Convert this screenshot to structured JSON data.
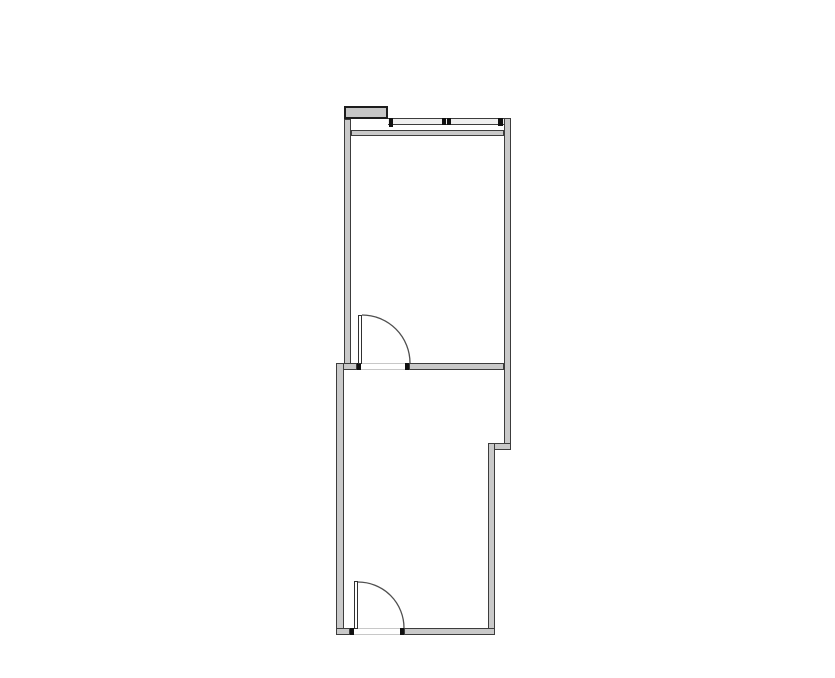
{
  "document": {
    "kind": "architectural-floor-plan",
    "visible_text": []
  },
  "canvas": {
    "width": 835,
    "height": 678,
    "background": "#ffffff"
  },
  "palette": {
    "wall_fill": "#c9c9c9",
    "wall_edge": "#3c3c3c",
    "tab_fill": "#c6c6c6",
    "tab_edge": "#1c1c1c",
    "glass_fill": "#efefef",
    "mullion_mark": "#101010",
    "threshold_edge": "#c8c8c8",
    "door_arc_stroke": "#4f4f4f",
    "door_leaf_fill": "#ffffff"
  },
  "floorplan": {
    "rooms": [
      {
        "name": "upper-room",
        "bounds": {
          "x": 344,
          "y": 106,
          "w": 167,
          "h": 264
        }
      },
      {
        "name": "lower-room",
        "bounds": {
          "x": 336,
          "y": 363,
          "w": 175,
          "h": 272
        }
      }
    ],
    "layers": {
      "walls": [
        {
          "name": "wall-left-upper",
          "x": 344,
          "y": 119,
          "w": 7,
          "h": 251
        },
        {
          "name": "wall-right-upper",
          "x": 504,
          "y": 118,
          "w": 7,
          "h": 332
        },
        {
          "name": "wall-top-inner-band",
          "x": 351,
          "y": 130,
          "w": 153,
          "h": 6
        },
        {
          "name": "wall-divider-left-stub",
          "x": 336,
          "y": 363,
          "w": 21,
          "h": 7
        },
        {
          "name": "wall-divider-right",
          "x": 409,
          "y": 363,
          "w": 95,
          "h": 7
        },
        {
          "name": "wall-left-lower",
          "x": 336,
          "y": 363,
          "w": 8,
          "h": 272
        },
        {
          "name": "wall-step-notch",
          "x": 488,
          "y": 443,
          "w": 23,
          "h": 7
        },
        {
          "name": "wall-right-lower",
          "x": 488,
          "y": 443,
          "w": 7,
          "h": 192
        },
        {
          "name": "wall-bottom-left-stub",
          "x": 336,
          "y": 628,
          "w": 14,
          "h": 7
        },
        {
          "name": "wall-bottom-right",
          "x": 404,
          "y": 628,
          "w": 91,
          "h": 7
        }
      ],
      "tabs": [
        {
          "name": "entry-tab-top-left",
          "x": 344,
          "y": 106,
          "w": 44,
          "h": 13
        }
      ],
      "glazing": [
        {
          "name": "window-band-top",
          "x": 388,
          "y": 118,
          "w": 116,
          "h": 7
        }
      ],
      "marks": [
        {
          "name": "window-post-left",
          "x": 389,
          "y": 118,
          "w": 4,
          "h": 9
        },
        {
          "name": "window-mullion-a",
          "x": 442,
          "y": 118,
          "w": 4,
          "h": 7
        },
        {
          "name": "window-mullion-b",
          "x": 447,
          "y": 118,
          "w": 4,
          "h": 7
        },
        {
          "name": "window-post-right",
          "x": 498,
          "y": 118,
          "w": 5,
          "h": 8
        },
        {
          "name": "door-jamb-mid-left",
          "x": 357,
          "y": 363,
          "w": 4,
          "h": 7
        },
        {
          "name": "door-jamb-mid-right",
          "x": 405,
          "y": 363,
          "w": 4,
          "h": 7
        },
        {
          "name": "door-jamb-bottom-left",
          "x": 350,
          "y": 628,
          "w": 4,
          "h": 7
        },
        {
          "name": "door-jamb-bottom-right",
          "x": 400,
          "y": 628,
          "w": 4,
          "h": 7
        }
      ],
      "thresholds": [
        {
          "name": "door-threshold-mid",
          "x": 361,
          "y": 363,
          "w": 44,
          "h": 7
        },
        {
          "name": "door-threshold-bottom",
          "x": 354,
          "y": 628,
          "w": 46,
          "h": 7
        }
      ],
      "leaves": [
        {
          "name": "door-leaf-mid",
          "x": 358,
          "y": 315,
          "w": 4,
          "h": 49
        },
        {
          "name": "door-leaf-bottom",
          "x": 354,
          "y": 581,
          "w": 4,
          "h": 48
        }
      ]
    },
    "arcs": [
      {
        "name": "door-arc-mid",
        "d": "M 362 315 A 48 48 0 0 1 410 363"
      },
      {
        "name": "door-arc-bottom",
        "d": "M 358 582 A 46 46 0 0 1 404 628"
      }
    ]
  }
}
